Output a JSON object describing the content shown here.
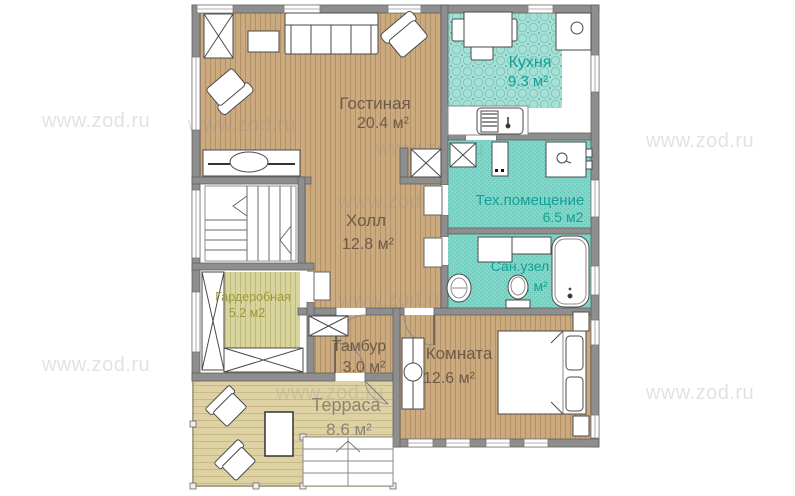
{
  "watermark": "www.zod.ru",
  "rooms": {
    "living": {
      "label": "Гостиная",
      "area": "20.4 м²"
    },
    "kitchen": {
      "label": "Кухня",
      "area": "9.3 м²"
    },
    "hall": {
      "label": "Холл",
      "area": "12.8 м²"
    },
    "tech": {
      "label": "Тех.помещение",
      "area": "6.5 м2"
    },
    "bathroom": {
      "label": "Сан.узел",
      "area": "6.1 м²"
    },
    "wardrobe": {
      "label": "Гардеробная",
      "area": "5.2 м2"
    },
    "tambour": {
      "label": "Тамбур",
      "area": "3.0 м²"
    },
    "bedroom": {
      "label": "Комната",
      "area": "12.6 м²"
    },
    "terrace": {
      "label": "Терраса",
      "area": "8.6 м²"
    }
  },
  "colors": {
    "wall": "#8e8e8e",
    "wood_floor": "#cbaa7d",
    "kitchen_floor": "#a8e0d7",
    "wet_floor": "#85d4c8",
    "olive_floor": "#d8d49e",
    "terrace_floor": "#ded2a4",
    "teal_text": "#12a096",
    "brown_text": "#6e5b49",
    "olive_text": "#9a9a3c",
    "terrace_text": "#8b8577"
  }
}
